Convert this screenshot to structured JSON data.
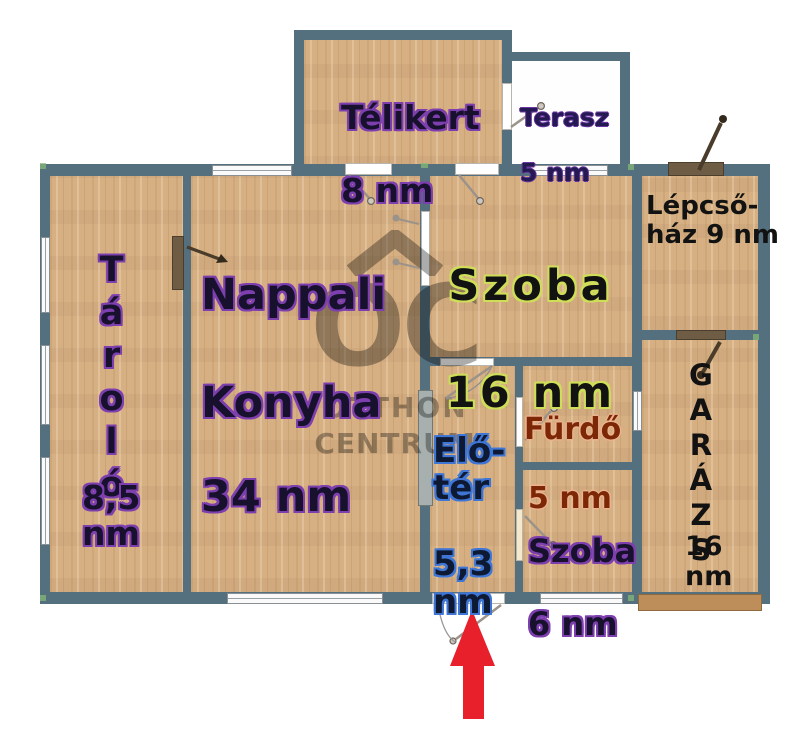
{
  "plan": {
    "type": "floor-plan",
    "unit_note": "nm = négyzetméter (square meter)"
  },
  "rooms": {
    "telikert": {
      "name": "Télikert",
      "area": "8 nm"
    },
    "terasz": {
      "name": "Terasz",
      "area": "5 nm"
    },
    "lepcsohaz": {
      "label": "Lépcső-\nház 9 nm"
    },
    "szoba16": {
      "name": "Szoba",
      "area": "16 nm"
    },
    "nappali": {
      "line1": "Nappali",
      "line2": "Konyha",
      "area": "34 nm"
    },
    "tarolo": {
      "name": "Tároló",
      "area": "8,5 nm"
    },
    "eloter": {
      "name": "Elő-\ntér",
      "area": "5,3\nnm"
    },
    "furdo": {
      "name": "Fürdő",
      "area": "5 nm"
    },
    "szoba6": {
      "name": "Szoba",
      "area": "6 nm"
    },
    "garazs": {
      "name": "GARÁZS",
      "area": "16 nm"
    }
  },
  "watermark": {
    "logo": "OC",
    "line1": "OTTHON",
    "line2": "CENTRUM"
  },
  "colors": {
    "wall": "#546f7d",
    "wood": "#d6b083",
    "arrow": "#e8202b",
    "wm": "#5f5f5f"
  },
  "icons": {
    "entrance_arrow": "up-arrow marking the main entrance"
  }
}
